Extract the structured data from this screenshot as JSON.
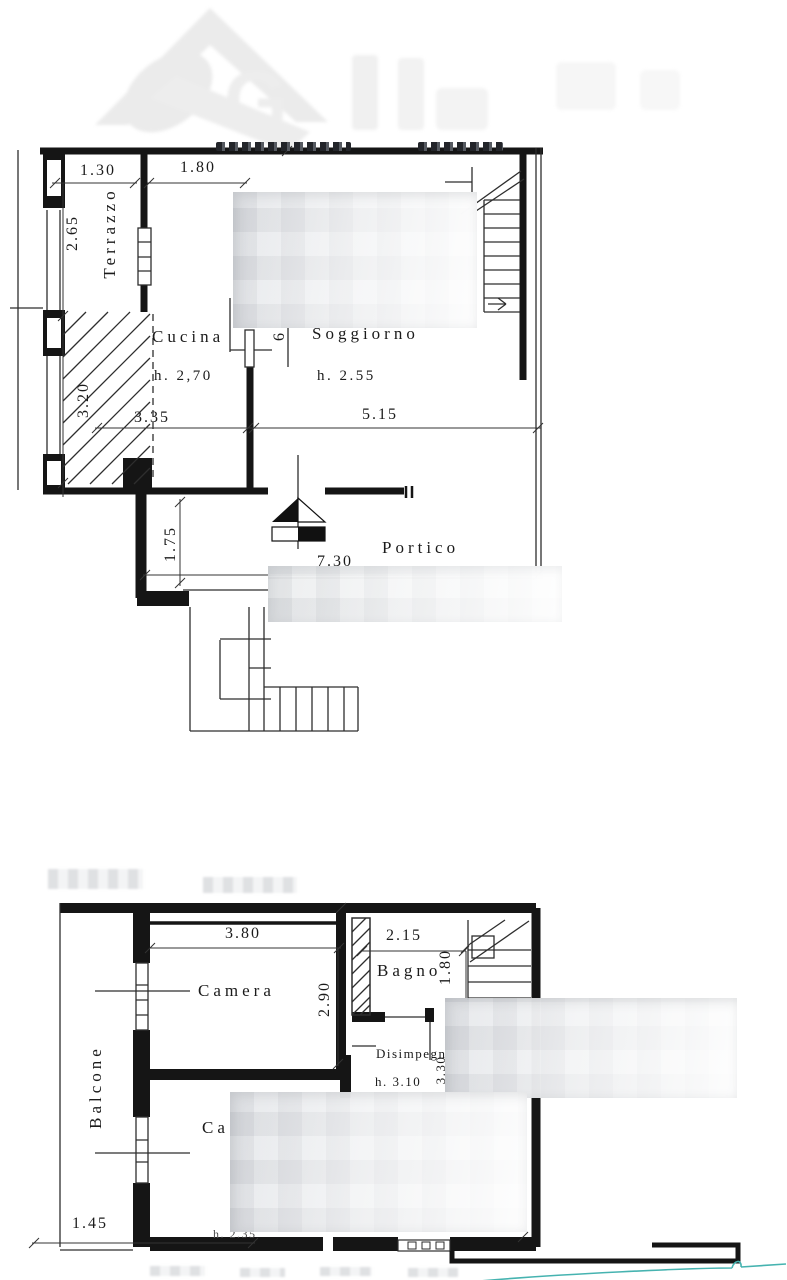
{
  "watermark": {
    "letter": "G"
  },
  "upper_plan": {
    "room_labels": {
      "terrazzo": "Terrazzo",
      "cucina": "Cucina",
      "cucina_height": "h. 2,70",
      "soggiorno": "Soggiorno",
      "soggiorno_height": "h. 2.55",
      "portico": "Portico"
    },
    "dimensions": {
      "terrace_width": "1.30",
      "opening_width": "1.80",
      "terrace_length": "2.65",
      "ramp_length": "3.20",
      "kitchen_width": "3.35",
      "door_width": "6",
      "living_width": "5.15",
      "portico_depth": "1.75",
      "portico_width": "7.30"
    }
  },
  "lower_plan": {
    "room_labels": {
      "balcone": "Balcone",
      "camera": "Camera",
      "bagno": "Bagno",
      "disimpegno_partial": "Disimpegn",
      "disimpegno_height": "h. 3.10",
      "camera2_partial": "Ca",
      "camera2_height": "h. 2.35"
    },
    "dimensions": {
      "camera_width": "3.80",
      "camera_depth": "2.90",
      "bagno_width": "2.15",
      "stair_width": "1.80",
      "corridor_length": "3.30",
      "balcony_width": "1.45"
    }
  }
}
